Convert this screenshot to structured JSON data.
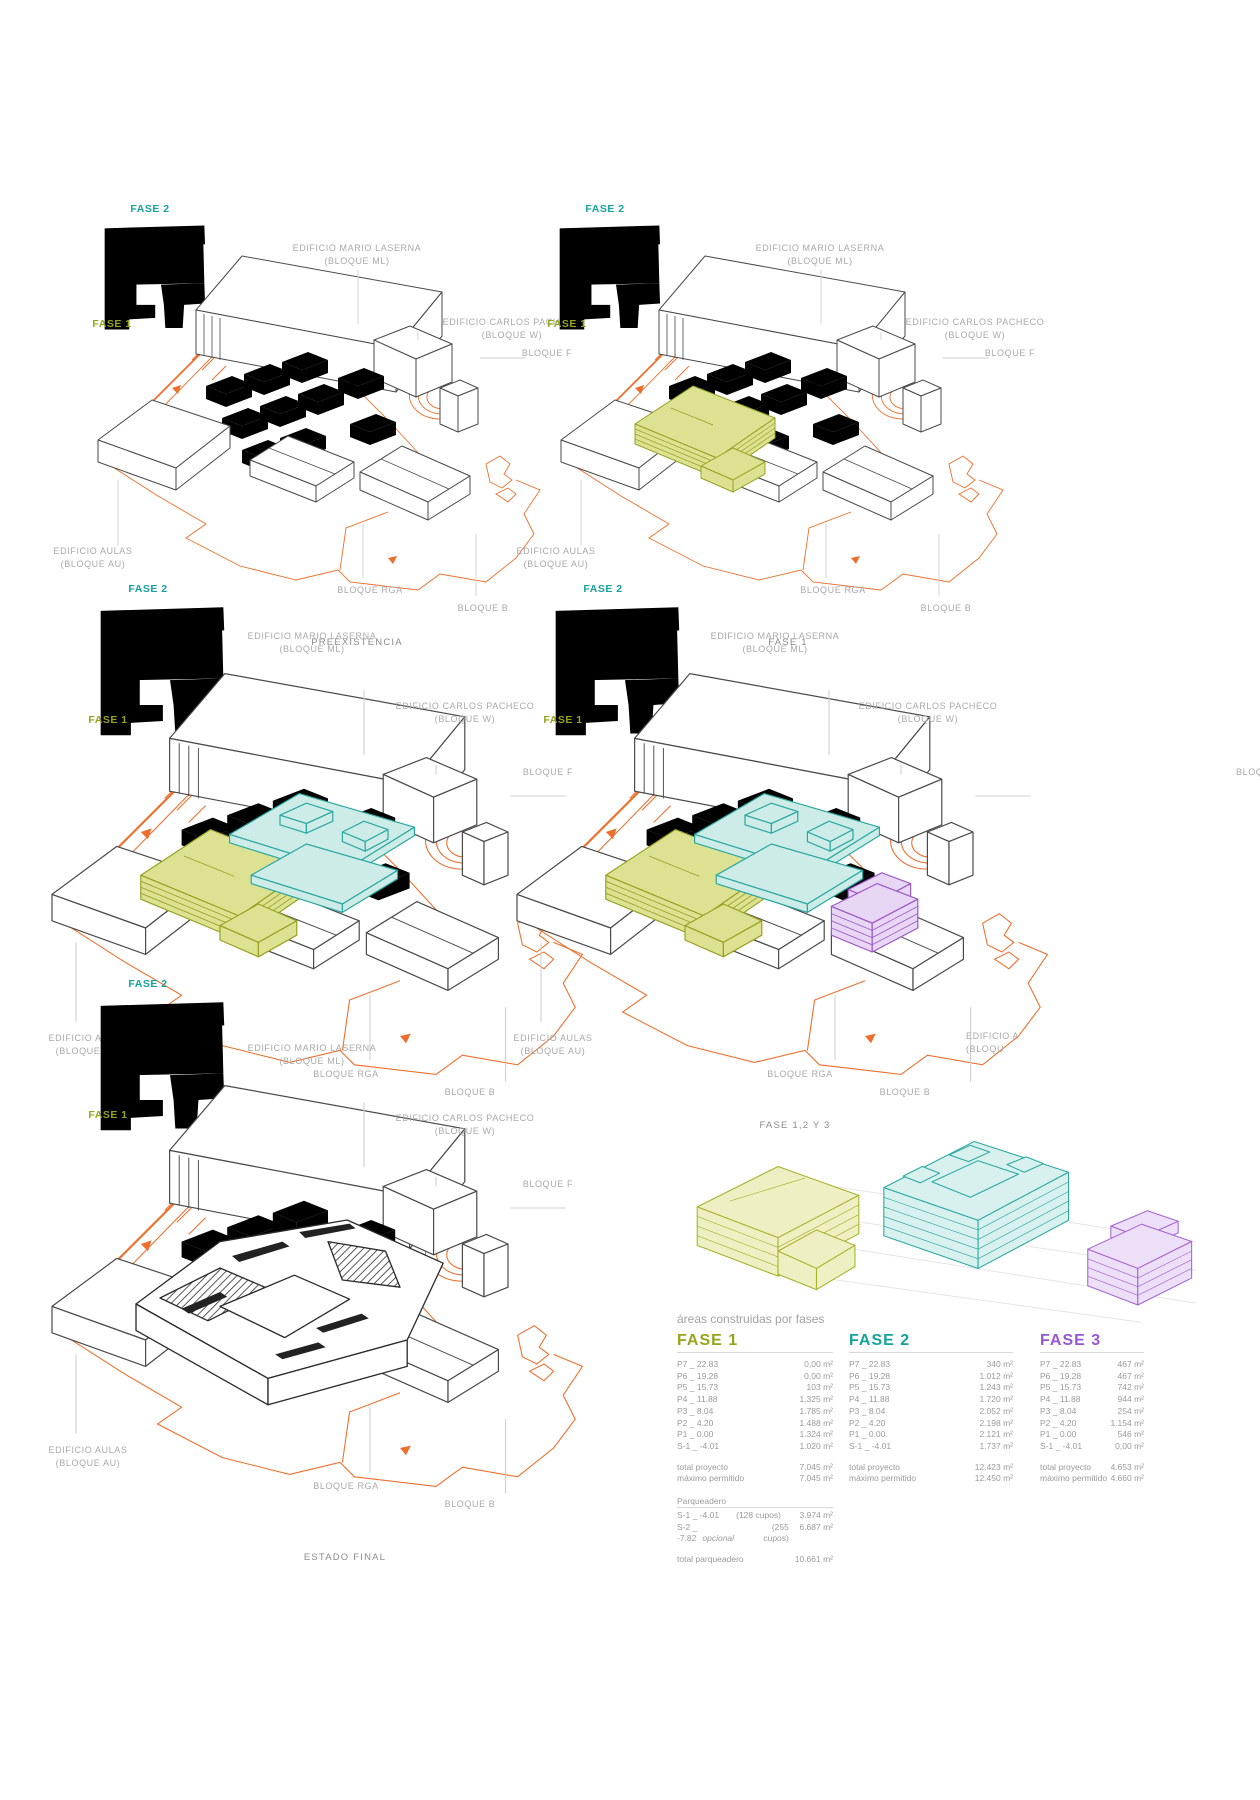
{
  "colors": {
    "fase1": "#97a31b",
    "fase2": "#14a39d",
    "fase3": "#9757cf",
    "orange": "#ed6f2d"
  },
  "fases": {
    "f1": "FASE 1",
    "f2": "FASE 2",
    "f3": "FASE 3"
  },
  "captions": {
    "d1": "PREEXISTENCIA",
    "d2": "FASE 1",
    "d3": "FASE 1 Y 2",
    "d4": "FASE 1,2 Y 3",
    "d5": "ESTADO FINAL"
  },
  "labels": {
    "edificio_ml_1": "EDIFICIO MARIO LASERNA",
    "edificio_ml_2": "(BLOQUE ML)",
    "edificio_cp_1": "EDIFICIO CARLOS PACHECO",
    "edificio_cp_2": "(BLOQUE W)",
    "bloque_f": "BLOQUE F",
    "edificio_au_1": "EDIFICIO AULAS",
    "edificio_au_2": "(BLOQUE AU)",
    "bloque_rga": "BLOQUE RGA",
    "bloque_b": "BLOQUE B",
    "bloque_f_cut": "BLOQ",
    "edificio_au_cut_1": "EDIFICIO A",
    "edificio_au_cut_2": "(BLOQU"
  },
  "table": {
    "title": "áreas construidas por fases",
    "total_label": "total proyecto",
    "max_label": "máximo permitido",
    "columns": [
      {
        "header": "FASE 1",
        "rows": [
          {
            "l": "P7 _ 22.83",
            "v": "0,00 m²"
          },
          {
            "l": "P6 _ 19.28",
            "v": "0,00 m²"
          },
          {
            "l": "P5 _ 15.73",
            "v": "103 m²"
          },
          {
            "l": "P4 _ 11.88",
            "v": "1.325 m²"
          },
          {
            "l": "P3 _ 8.04",
            "v": "1.785 m²"
          },
          {
            "l": "P2 _ 4.20",
            "v": "1.488 m²"
          },
          {
            "l": "P1 _ 0.00",
            "v": "1.324 m²"
          },
          {
            "l": "S-1 _ -4.01",
            "v": "1.020 m²"
          }
        ],
        "total_value": "7.045 m²",
        "max_value": "7.045 m²"
      },
      {
        "header": "FASE 2",
        "rows": [
          {
            "l": "P7 _ 22.83",
            "v": "340 m²"
          },
          {
            "l": "P6 _ 19.28",
            "v": "1.012 m²"
          },
          {
            "l": "P5 _ 15.73",
            "v": "1.243 m²"
          },
          {
            "l": "P4 _ 11.88",
            "v": "1.720 m²"
          },
          {
            "l": "P3 _ 8.04",
            "v": "2.052 m²"
          },
          {
            "l": "P2 _ 4.20",
            "v": "2.198 m²"
          },
          {
            "l": "P1 _ 0.00",
            "v": "2.121 m²"
          },
          {
            "l": "S-1 _ -4.01",
            "v": "1.737 m²"
          }
        ],
        "total_value": "12.423 m²",
        "max_value": "12.450 m²"
      },
      {
        "header": "FASE 3",
        "rows": [
          {
            "l": "P7 _ 22.83",
            "v": "467 m²"
          },
          {
            "l": "P6 _ 19.28",
            "v": "467 m²"
          },
          {
            "l": "P5 _ 15.73",
            "v": "742 m²"
          },
          {
            "l": "P4 _ 11.88",
            "v": "944 m²"
          },
          {
            "l": "P3 _ 8.04",
            "v": "254 m²"
          },
          {
            "l": "P2 _ 4.20",
            "v": "1.154 m²"
          },
          {
            "l": "P1 _ 0.00",
            "v": "546 m²"
          },
          {
            "l": "S-1 _ -4.01",
            "v": "0,00 m²"
          }
        ],
        "total_value": "4.653 m²",
        "max_value": "4.660 m²"
      }
    ],
    "parqueadero": {
      "title": "Parqueadero",
      "rows": [
        {
          "l": "S-1 _ -4.01",
          "note": "",
          "c": "(128 cupos)",
          "v": "3.974 m²"
        },
        {
          "l": "S-2 _ -7.82",
          "note": "opcional",
          "c": "(255 cupos)",
          "v": "6.687 m²"
        }
      ],
      "total_label": "total parqueadero",
      "total_value": "10.661 m²"
    }
  }
}
